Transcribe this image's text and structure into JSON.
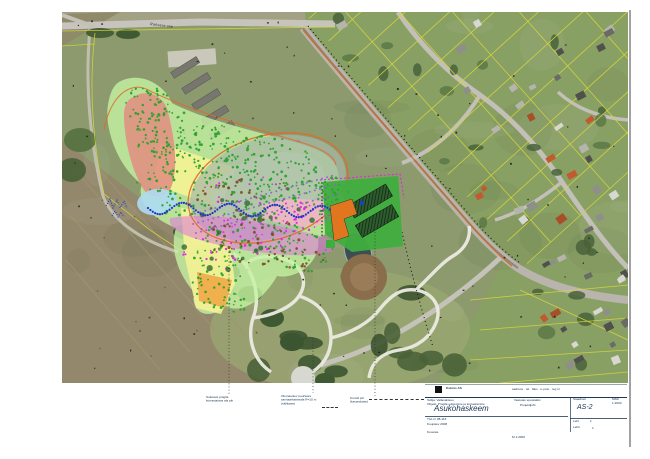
{
  "map": {
    "road_label": "Rakvere tee",
    "annotations": [
      {
        "lines": [
          "Suletava prügila",
          "korrastatava ala piir"
        ]
      },
      {
        "lines": [
          "Olemasolev puurkaev",
          "sanitaarkaitseala R=10 m",
          "(säilitatav)"
        ]
      },
      {
        "lines": [
          "Krundi piir",
          "(kavandatav)"
        ]
      }
    ]
  },
  "titleblock": {
    "company": "Kobras AS",
    "company_info": "aadress · tel · faks · e-post · reg nr",
    "client_line": "Tellija: Vallavalitsus",
    "project_line": "Objekt: Prügila sulgemine ja korrastamine",
    "mid_line1": "Vastutav spetsialist",
    "mid_line2": "Projektijuht",
    "stage_label": "Staadium",
    "stage_value": "TP",
    "scale_label": "Mõõt",
    "scale_value": "1:2000",
    "title": "Asukohaskeem",
    "code": "AS-2",
    "row3_line1": "Töö nr 08-116",
    "row3_line2": "Kuupäev 2008",
    "row3_line3": "Koostas",
    "sheet_label": "Leht",
    "sheet_value": "1",
    "sheets_label": "Lehti",
    "sheets_value": "1",
    "scale_note": "M 1:2000"
  },
  "colors": {
    "palegreen": "#c6f2a2",
    "yellow": "#f8f394",
    "orangepatch": "#f0a845",
    "redblob": "#e28c80",
    "lightblue": "#aedcf2",
    "mound": "#a8b9a8",
    "pink": "#f3b6c6",
    "magenta": "#df72df",
    "facilitygreen": "#3fae3f",
    "facilityorange": "#e2761e",
    "outlineorange": "#e06a28",
    "cadastral": "#d6d63a",
    "greendot": "#2da02d",
    "magentadot": "#e028e0",
    "purpledot": "#8f66c4",
    "bluedot": "#1e34c8",
    "browndot": "#7b5226"
  }
}
